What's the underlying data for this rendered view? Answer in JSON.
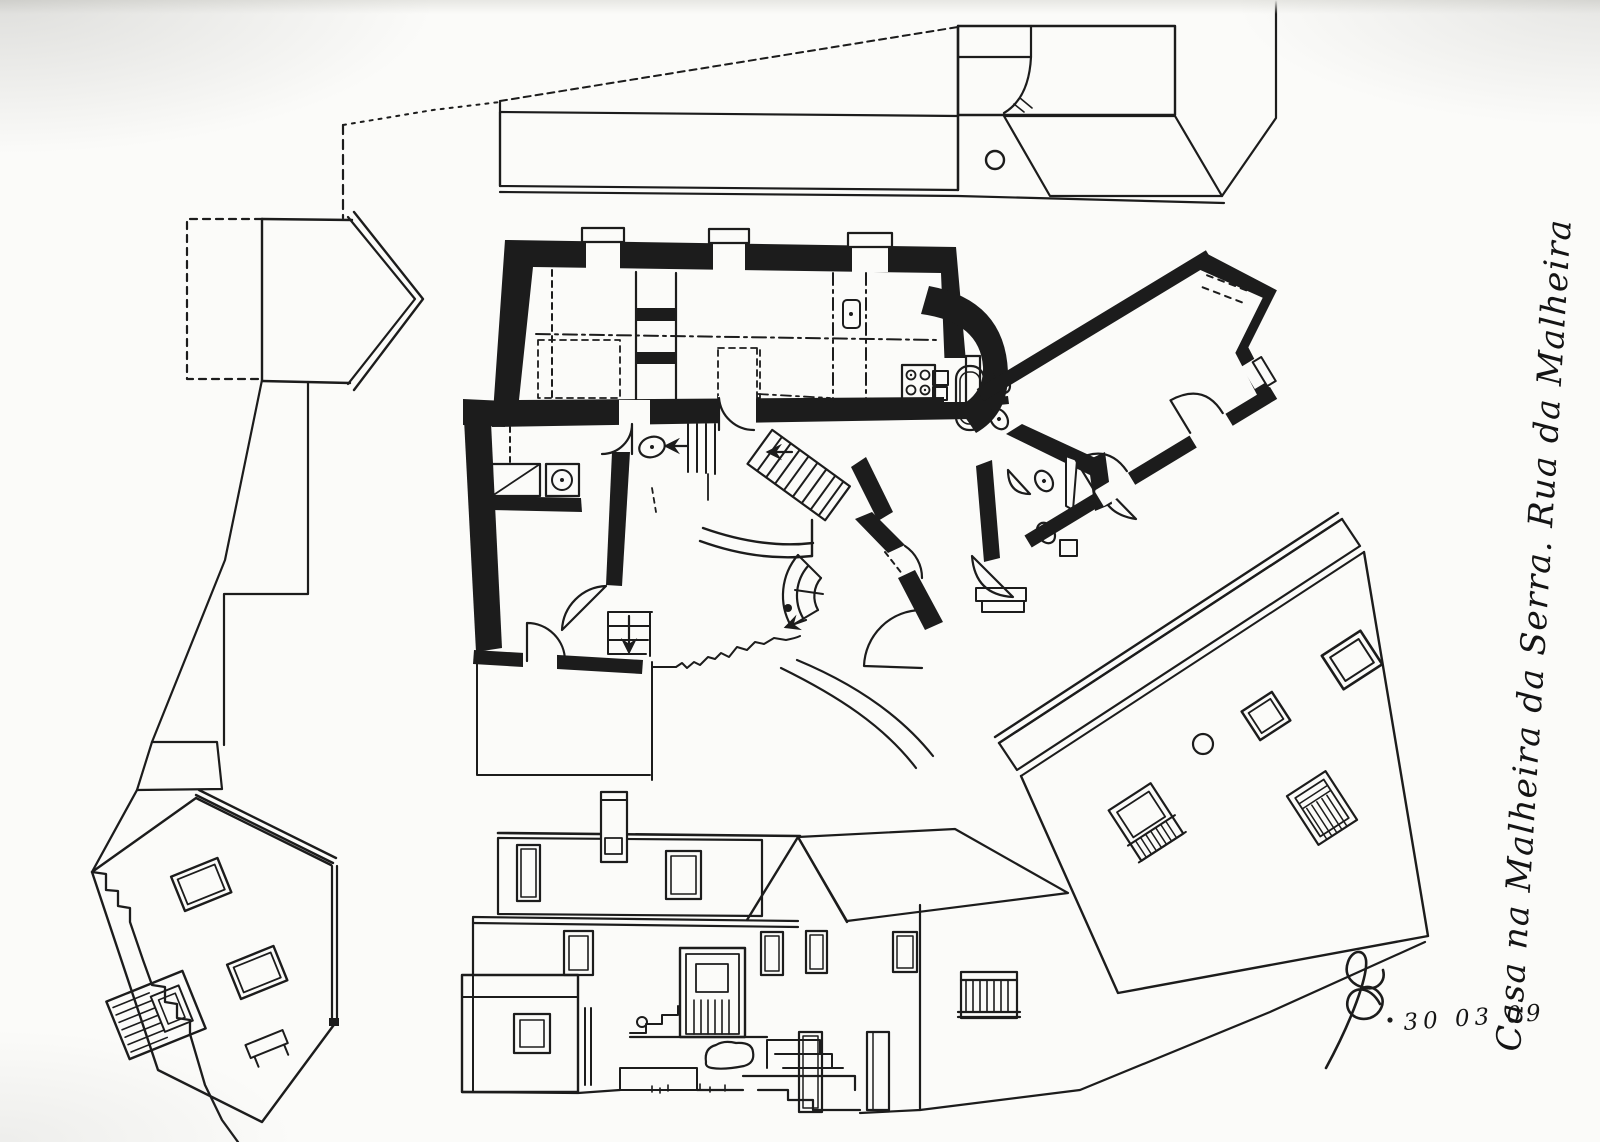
{
  "colors": {
    "ink": "#1c1c1c",
    "paper": "#fbfbf9"
  },
  "annotations": {
    "side_note": "Casa na Malheira da Serra. Rua da Malheira",
    "signature_date": "30 03 09"
  }
}
